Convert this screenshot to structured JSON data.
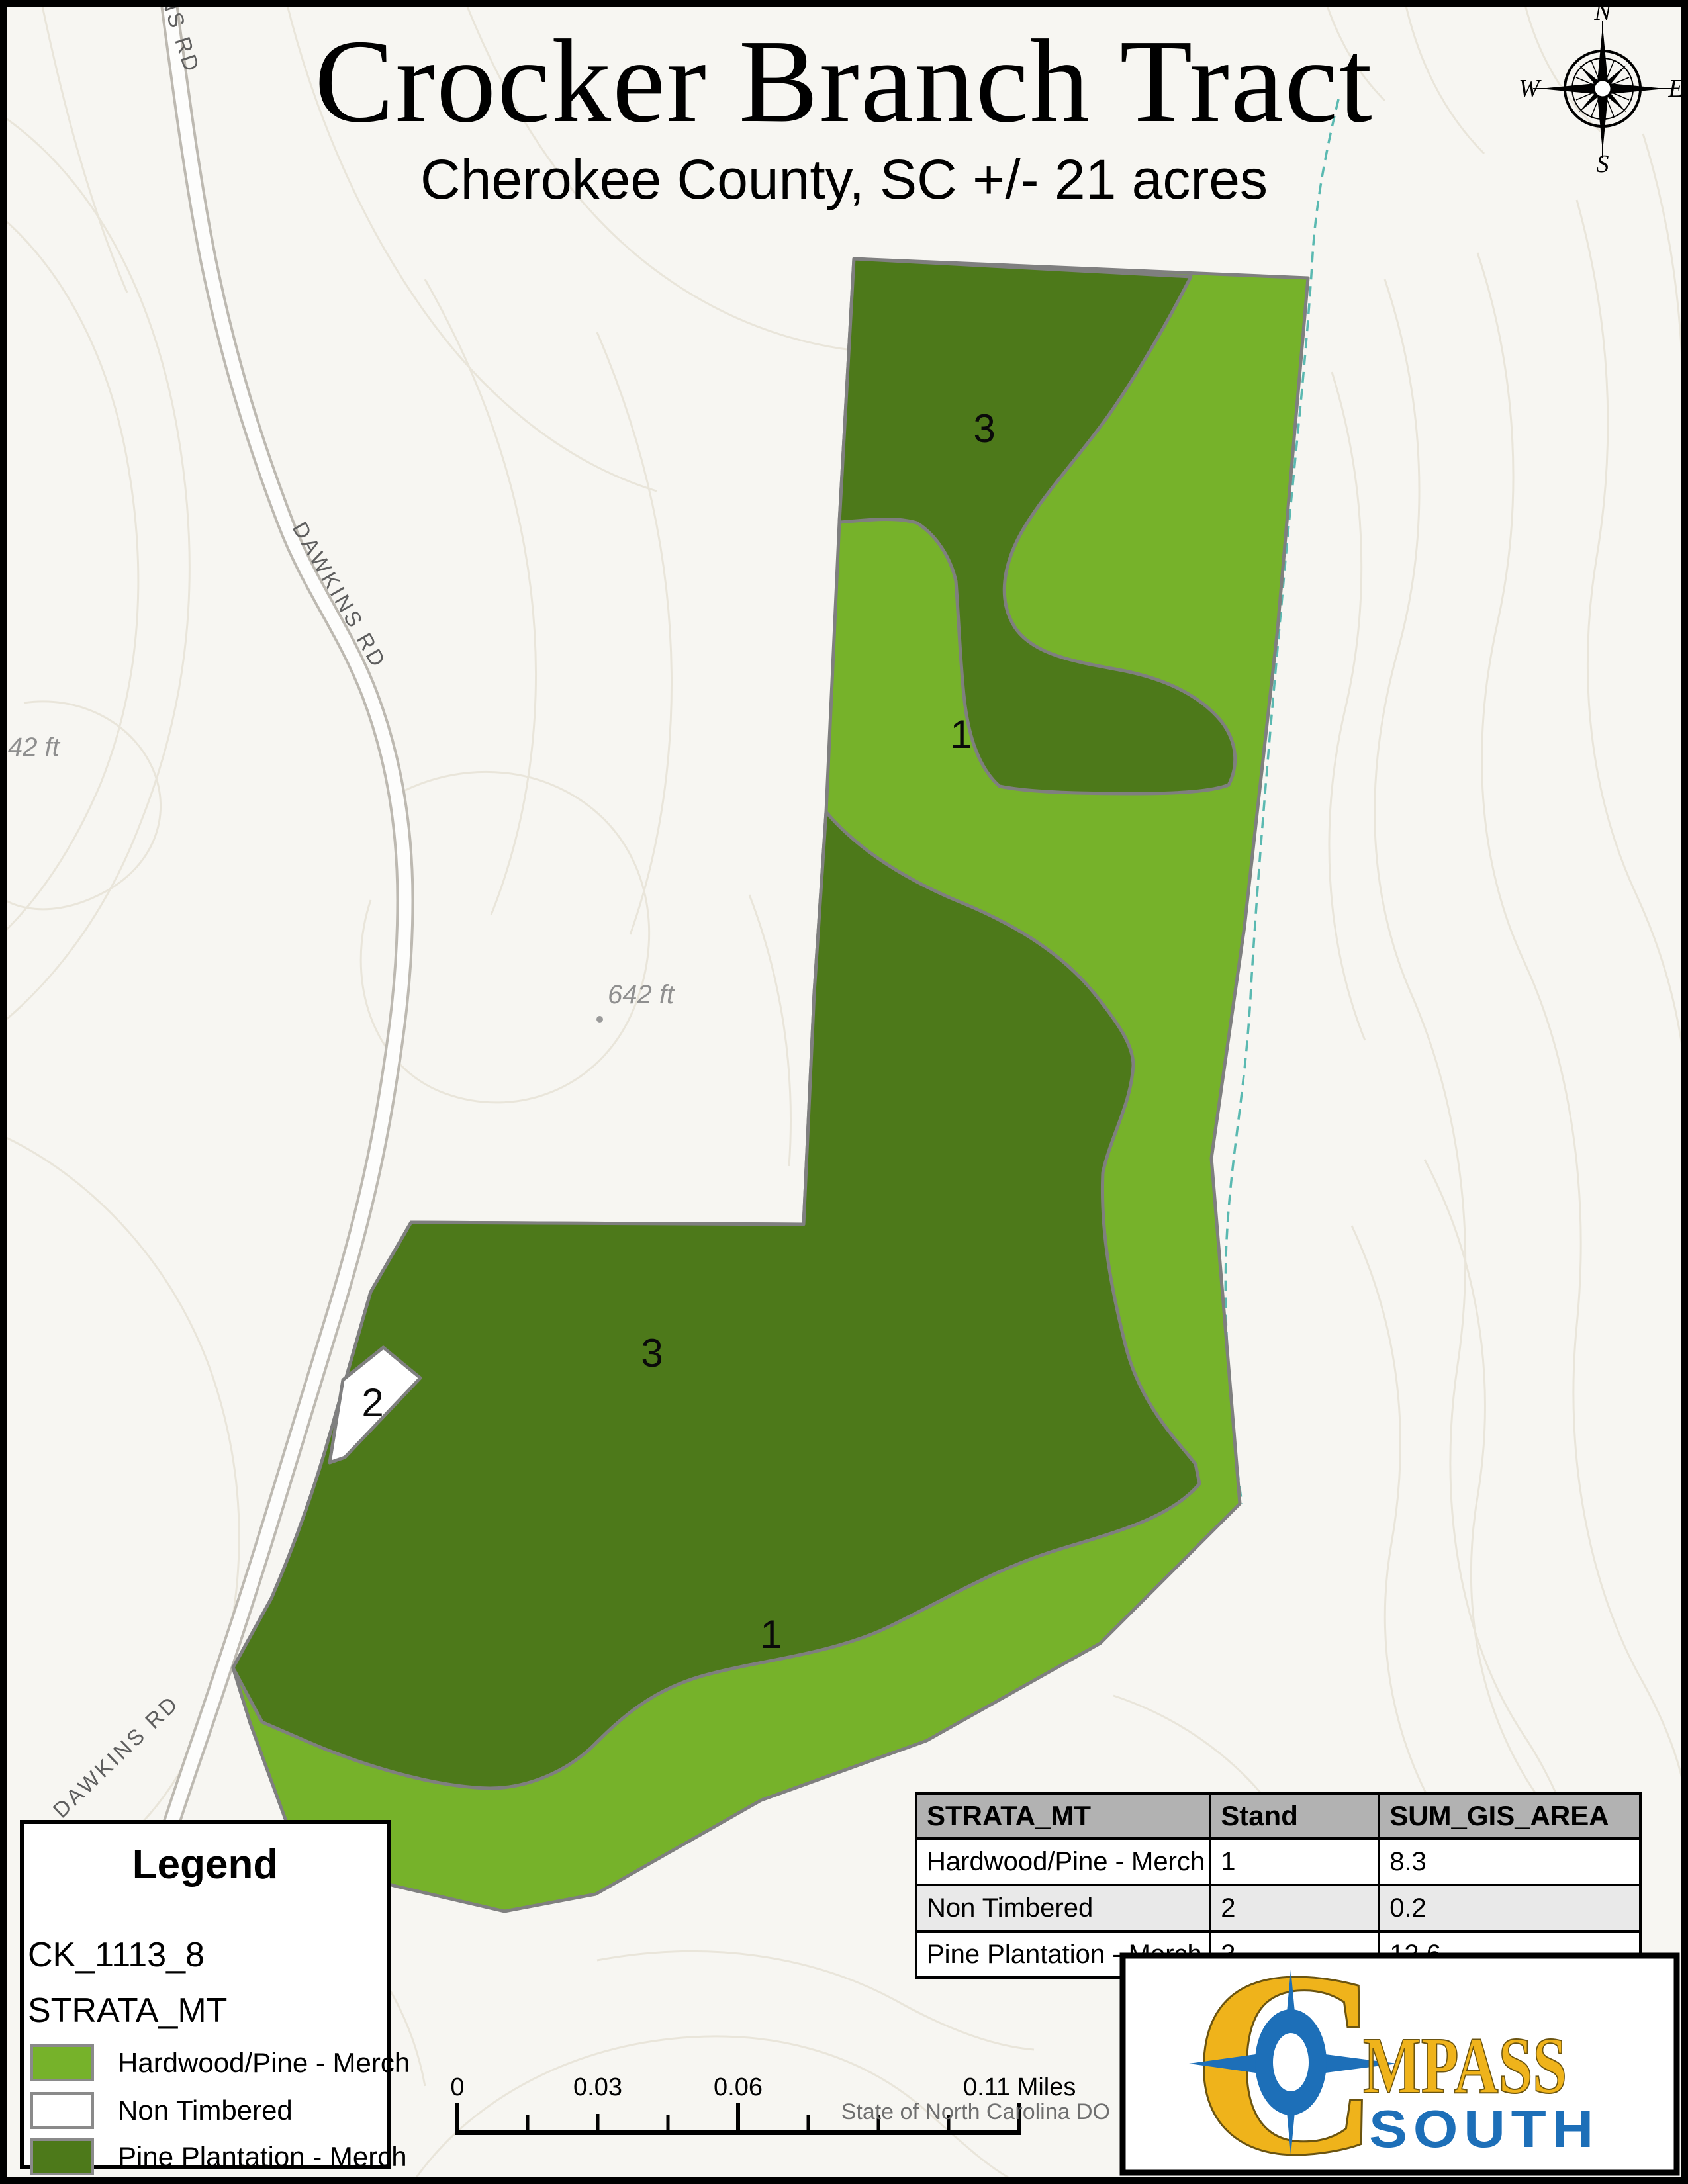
{
  "page": {
    "title": "Crocker Branch Tract",
    "subtitle": "Cherokee County, SC +/- 21 acres"
  },
  "compass": {
    "n": "N",
    "e": "E",
    "s": "S",
    "w": "W"
  },
  "map": {
    "stand_labels": [
      {
        "id": "stand-3-upper",
        "text": "3"
      },
      {
        "id": "stand-1-upper",
        "text": "1"
      },
      {
        "id": "stand-3-lower",
        "text": "3"
      },
      {
        "id": "stand-1-lower",
        "text": "1"
      },
      {
        "id": "stand-2",
        "text": "2"
      }
    ],
    "road_labels": [
      {
        "text": "DAWKINS RD"
      },
      {
        "text": "DAWKINS RD"
      },
      {
        "text": "NS RD"
      }
    ],
    "elevation_labels": [
      {
        "text": "642 ft"
      },
      {
        "text": "42 ft"
      }
    ],
    "colors": {
      "hardwood_pine": "#76b22a",
      "non_timbered": "#ffffff",
      "pine_plantation": "#4d791a",
      "stand_outline": "#7f7f7f",
      "contour": "#e9e5da",
      "stream": "#5ab9b1",
      "road_casing": "#bdb9b1",
      "road_fill": "#fdfdfc",
      "background": "#f7f6f2"
    }
  },
  "legend": {
    "title": "Legend",
    "layer_name": "CK_1113_8",
    "field_name": "STRATA_MT",
    "items": [
      {
        "label": "Hardwood/Pine - Merch",
        "color": "#76b22a"
      },
      {
        "label": "Non Timbered",
        "color": "#ffffff"
      },
      {
        "label": "Pine Plantation - Merch",
        "color": "#4d791a"
      }
    ]
  },
  "table": {
    "columns": [
      "STRATA_MT",
      "Stand",
      "SUM_GIS_AREA"
    ],
    "rows": [
      [
        "Hardwood/Pine - Merch",
        "1",
        "8.3"
      ],
      [
        "Non Timbered",
        "2",
        "0.2"
      ],
      [
        "Pine Plantation - Merch",
        "3",
        "12.6"
      ]
    ]
  },
  "scalebar": {
    "labels": [
      "0",
      "0.03",
      "0.06"
    ],
    "end_label": "0.11 Miles"
  },
  "attribution": "State of North Carolina DO",
  "logo": {
    "initial": "C",
    "name_rest": "MPASS",
    "subtitle": "SOUTH",
    "yellow": "#efb31b",
    "blue": "#1d6fb8"
  }
}
